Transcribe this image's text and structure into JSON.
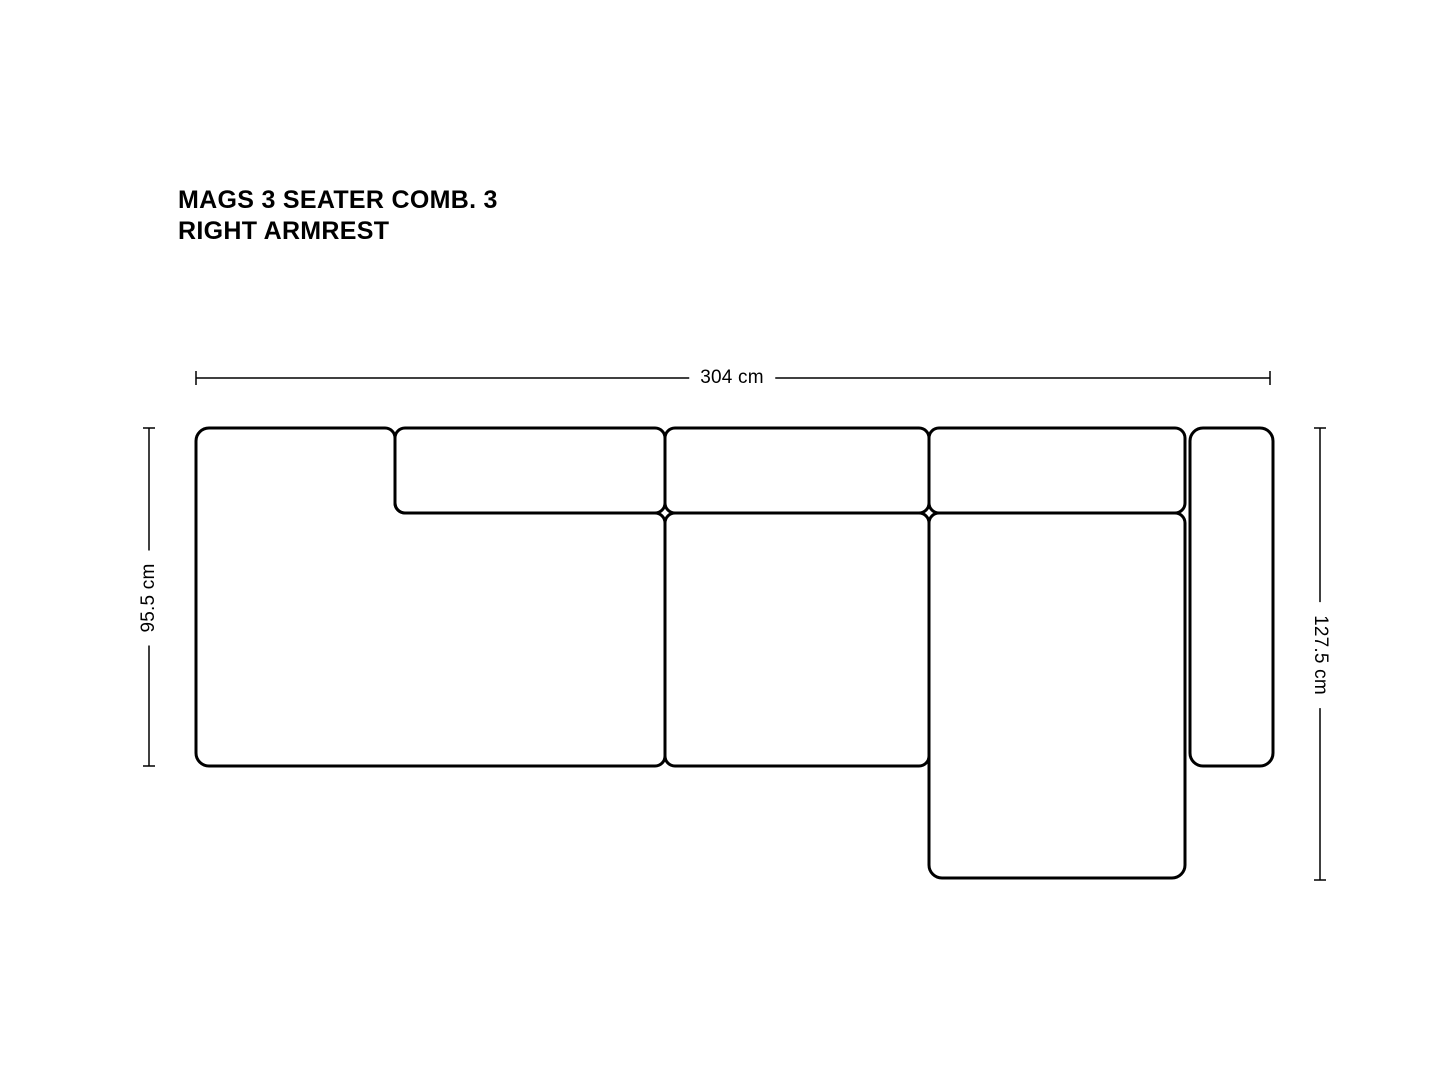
{
  "title": {
    "line1": "MAGS 3 SEATER COMB. 3",
    "line2": "RIGHT ARMREST"
  },
  "dimensions": {
    "overall_width_label": "304 cm",
    "seat_depth_label": "95.5 cm",
    "chaise_depth_label": "127.5 cm"
  },
  "colors": {
    "outline": "#000000",
    "dimension_line": "#000000",
    "background": "#ffffff"
  }
}
